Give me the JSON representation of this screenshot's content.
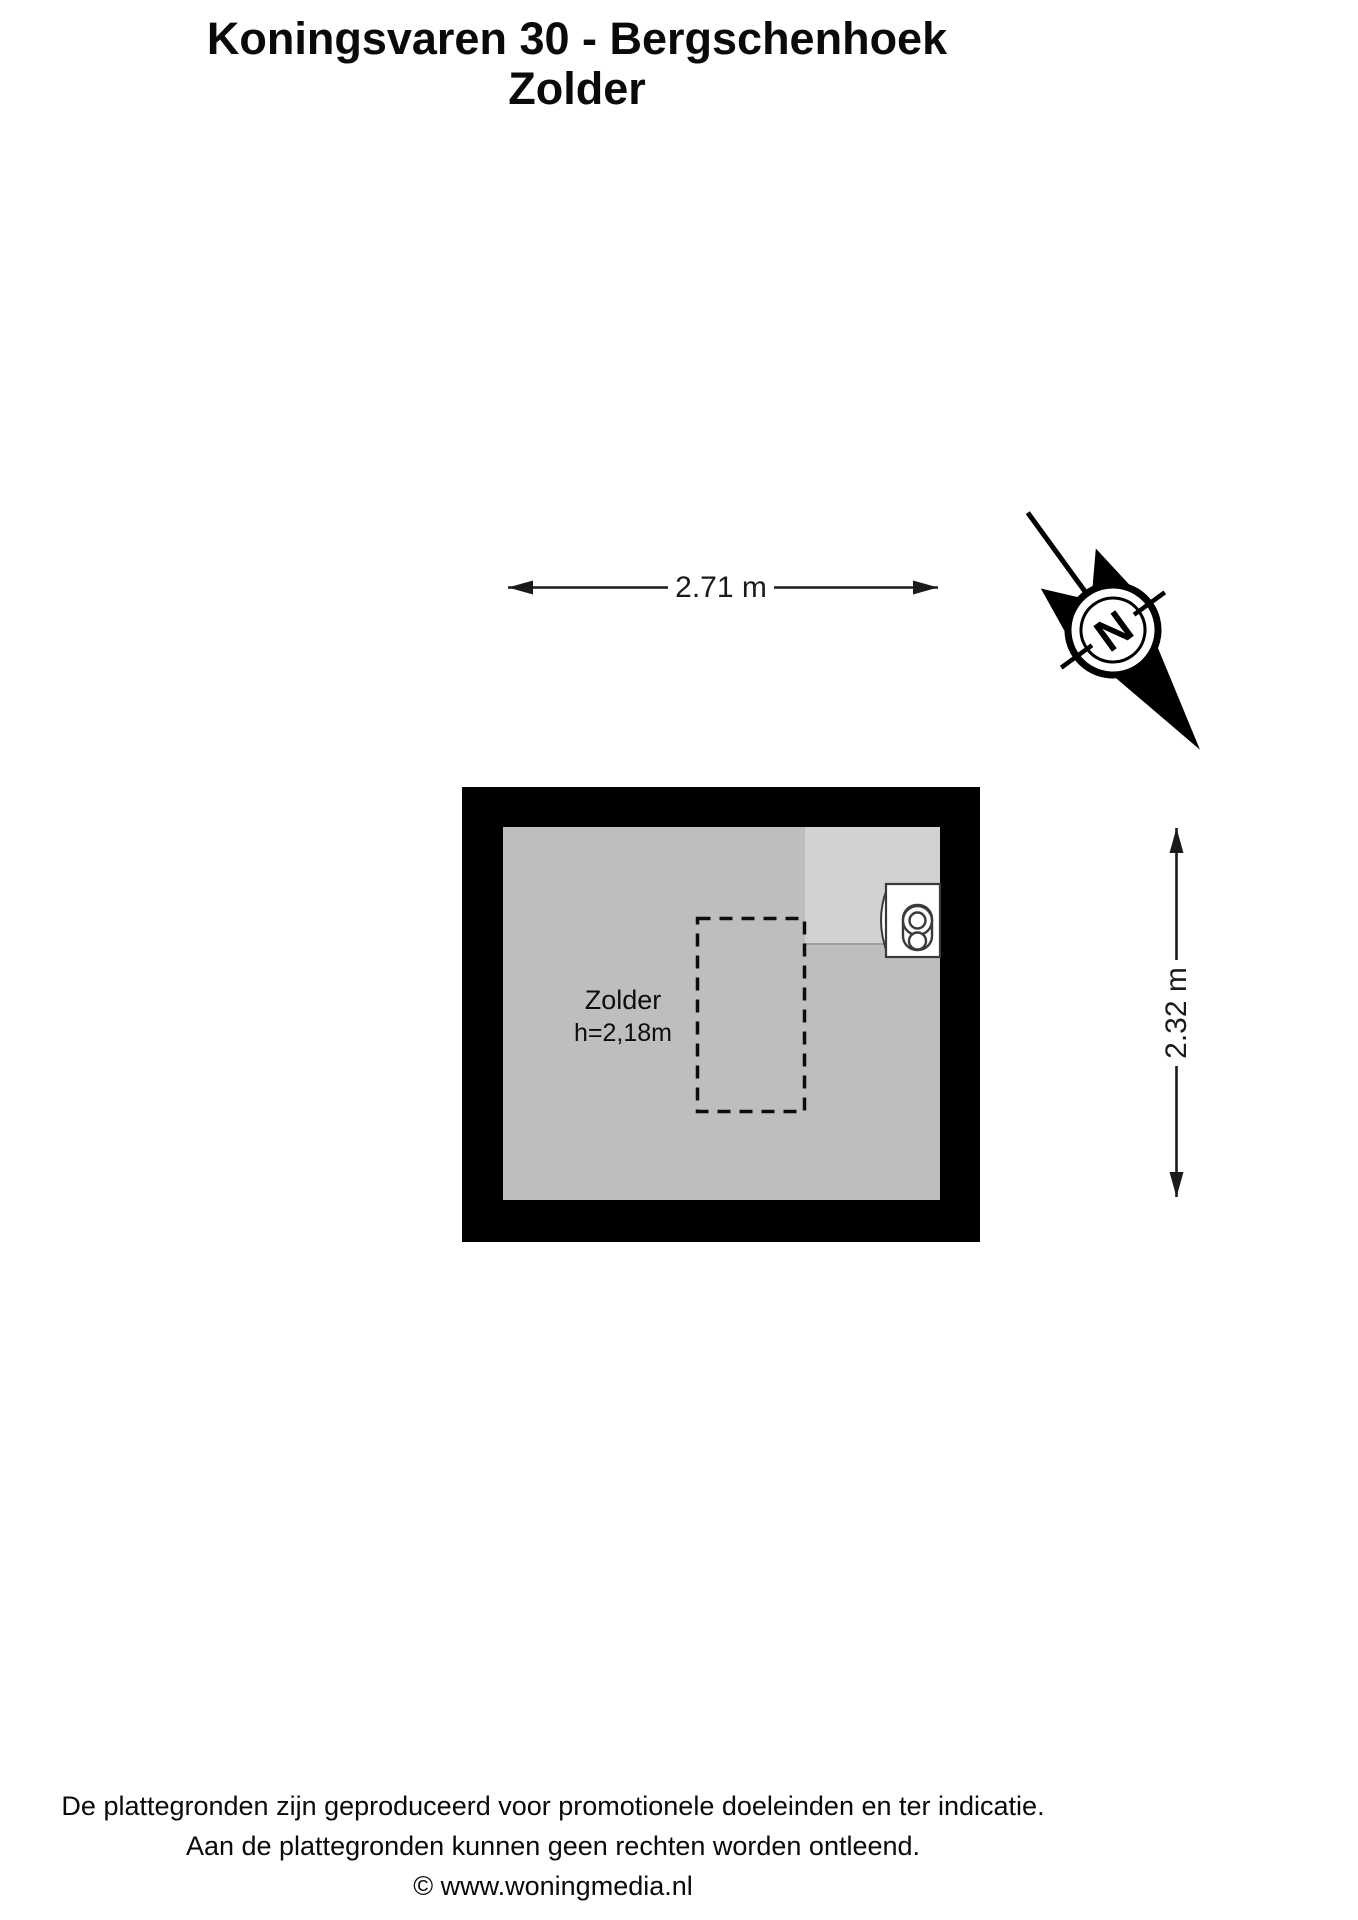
{
  "title": {
    "line1": "Koningsvaren 30 - Bergschenhoek",
    "line2": "Zolder"
  },
  "floor_plan": {
    "room": {
      "name": "Zolder",
      "height_label": "h=2,18m"
    },
    "dimensions": {
      "width_label": "2.71 m",
      "height_label": "2.32 m"
    },
    "compass": {
      "letter": "N"
    },
    "colors": {
      "wall": "#000000",
      "floor": "#bebebe",
      "floor_light": "#d2d2d2"
    }
  },
  "footer": {
    "line1": "De plattegronden zijn geproduceerd voor promotionele doeleinden en ter indicatie.",
    "line2": "Aan de plattegronden kunnen geen rechten worden ontleend.",
    "line3": "© www.woningmedia.nl"
  }
}
